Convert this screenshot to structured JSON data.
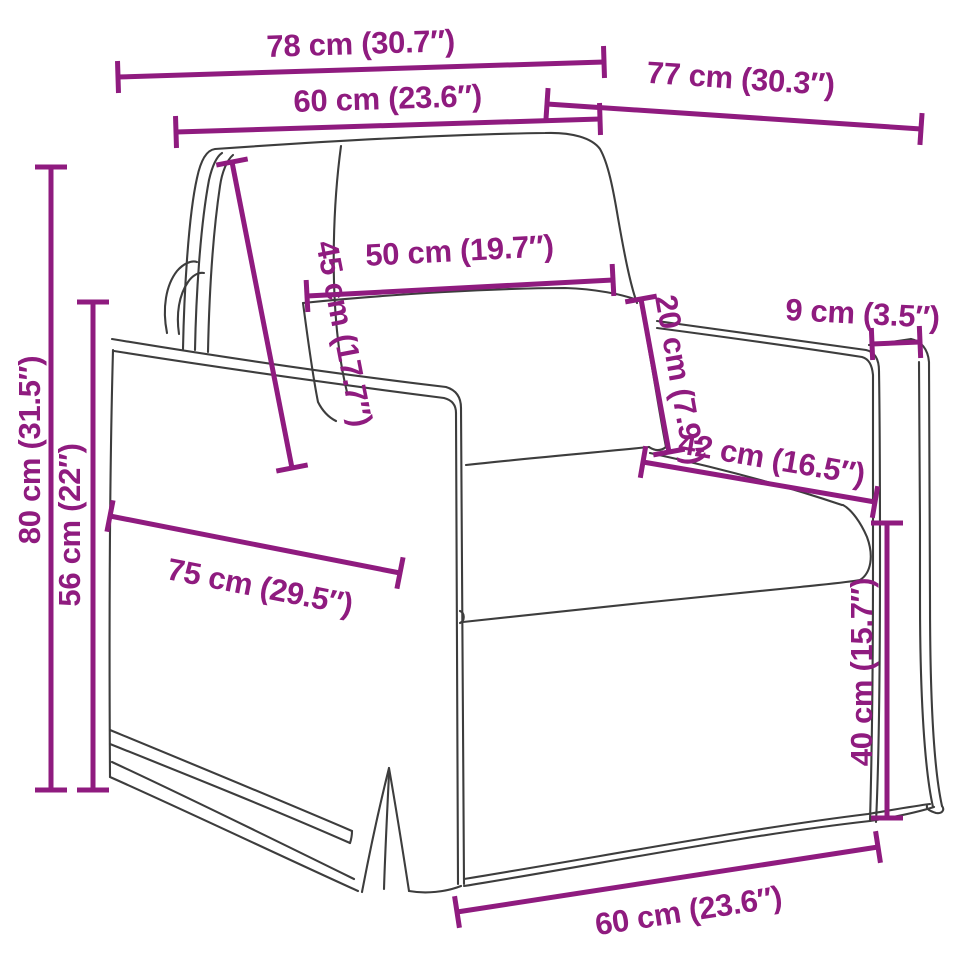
{
  "diagram": {
    "name": "armchair-dimension-diagram",
    "type": "product-dimension-diagram",
    "subject": "armchair with skirted base, back cushion and lumbar pillow",
    "background_color": "#ffffff",
    "outline_color": "#3d3d3d",
    "accent_color": "#8f1b7f",
    "canvas": {
      "width": 960,
      "height": 960
    },
    "dimensions": [
      {
        "id": "overall-width-top",
        "label": "78 cm (30.7″)",
        "cm": 78,
        "inch": 30.7,
        "line": {
          "x1": 118,
          "y1": 77,
          "x2": 604,
          "y2": 62
        },
        "text": {
          "x": 361,
          "y": 54,
          "rotate": -1.8,
          "anchor": "middle"
        }
      },
      {
        "id": "back-width-top",
        "label": "60 cm (23.6″)",
        "cm": 60,
        "inch": 23.6,
        "line": {
          "x1": 176,
          "y1": 132,
          "x2": 600,
          "y2": 119
        },
        "text": {
          "x": 388,
          "y": 109,
          "rotate": -1.8,
          "anchor": "middle"
        }
      },
      {
        "id": "overall-depth",
        "label": "77 cm (30.3″)",
        "cm": 77,
        "inch": 30.3,
        "line": {
          "x1": 547,
          "y1": 104,
          "x2": 921,
          "y2": 129
        },
        "text": {
          "x": 740,
          "y": 89,
          "rotate": 3.8,
          "anchor": "middle"
        }
      },
      {
        "id": "overall-height",
        "label": "80 cm (31.5″)",
        "cm": 80,
        "inch": 31.5,
        "line": {
          "x1": 51,
          "y1": 167,
          "x2": 51,
          "y2": 790
        },
        "text": {
          "x": 40,
          "y": 450,
          "rotate": -90,
          "anchor": "middle"
        }
      },
      {
        "id": "arm-height",
        "label": "56 cm (22″)",
        "cm": 56,
        "inch": 22,
        "line": {
          "x1": 93,
          "y1": 302,
          "x2": 93,
          "y2": 790
        },
        "text": {
          "x": 80,
          "y": 525,
          "rotate": -90,
          "anchor": "middle"
        }
      },
      {
        "id": "back-cushion-height",
        "label": "45 cm (17.7″)",
        "cm": 45,
        "inch": 17.7,
        "line": {
          "x1": 232,
          "y1": 162,
          "x2": 292,
          "y2": 468
        },
        "text": {
          "x": 316,
          "y": 243,
          "rotate": 79,
          "anchor": "start"
        }
      },
      {
        "id": "pillow-width",
        "label": "50 cm (19.7″)",
        "cm": 50,
        "inch": 19.7,
        "line": {
          "x1": 307,
          "y1": 296,
          "x2": 613,
          "y2": 280
        },
        "text": {
          "x": 460,
          "y": 261,
          "rotate": -3,
          "anchor": "middle"
        }
      },
      {
        "id": "pillow-height",
        "label": "20 cm (7.9″)",
        "cm": 20,
        "inch": 7.9,
        "line": {
          "x1": 641,
          "y1": 299,
          "x2": 669,
          "y2": 452
        },
        "text": {
          "x": 655,
          "y": 297,
          "rotate": 80,
          "anchor": "start"
        }
      },
      {
        "id": "arm-width",
        "label": "9 cm (3.5″)",
        "cm": 9,
        "inch": 3.5,
        "line": {
          "x1": 872,
          "y1": 344,
          "x2": 920,
          "y2": 342
        },
        "text": {
          "x": 862,
          "y": 324,
          "rotate": 3,
          "anchor": "middle"
        }
      },
      {
        "id": "seat-width",
        "label": "42 cm (16.5″)",
        "cm": 42,
        "inch": 16.5,
        "line": {
          "x1": 643,
          "y1": 462,
          "x2": 875,
          "y2": 502
        },
        "text": {
          "x": 770,
          "y": 469,
          "rotate": 9.8,
          "anchor": "middle"
        }
      },
      {
        "id": "seat-height",
        "label": "40 cm (15.7″)",
        "cm": 40,
        "inch": 15.7,
        "line": {
          "x1": 887,
          "y1": 523,
          "x2": 887,
          "y2": 818
        },
        "text": {
          "x": 872,
          "y": 672,
          "rotate": -90,
          "anchor": "middle"
        }
      },
      {
        "id": "side-depth",
        "label": "75 cm (29.5″)",
        "cm": 75,
        "inch": 29.5,
        "line": {
          "x1": 110,
          "y1": 516,
          "x2": 400,
          "y2": 573
        },
        "text": {
          "x": 258,
          "y": 597,
          "rotate": 11.1,
          "anchor": "middle"
        }
      },
      {
        "id": "front-width-bottom",
        "label": "60 cm (23.6″)",
        "cm": 60,
        "inch": 23.6,
        "line": {
          "x1": 457,
          "y1": 912,
          "x2": 878,
          "y2": 847
        },
        "text": {
          "x": 690,
          "y": 921,
          "rotate": -8.7,
          "anchor": "middle"
        }
      }
    ]
  }
}
